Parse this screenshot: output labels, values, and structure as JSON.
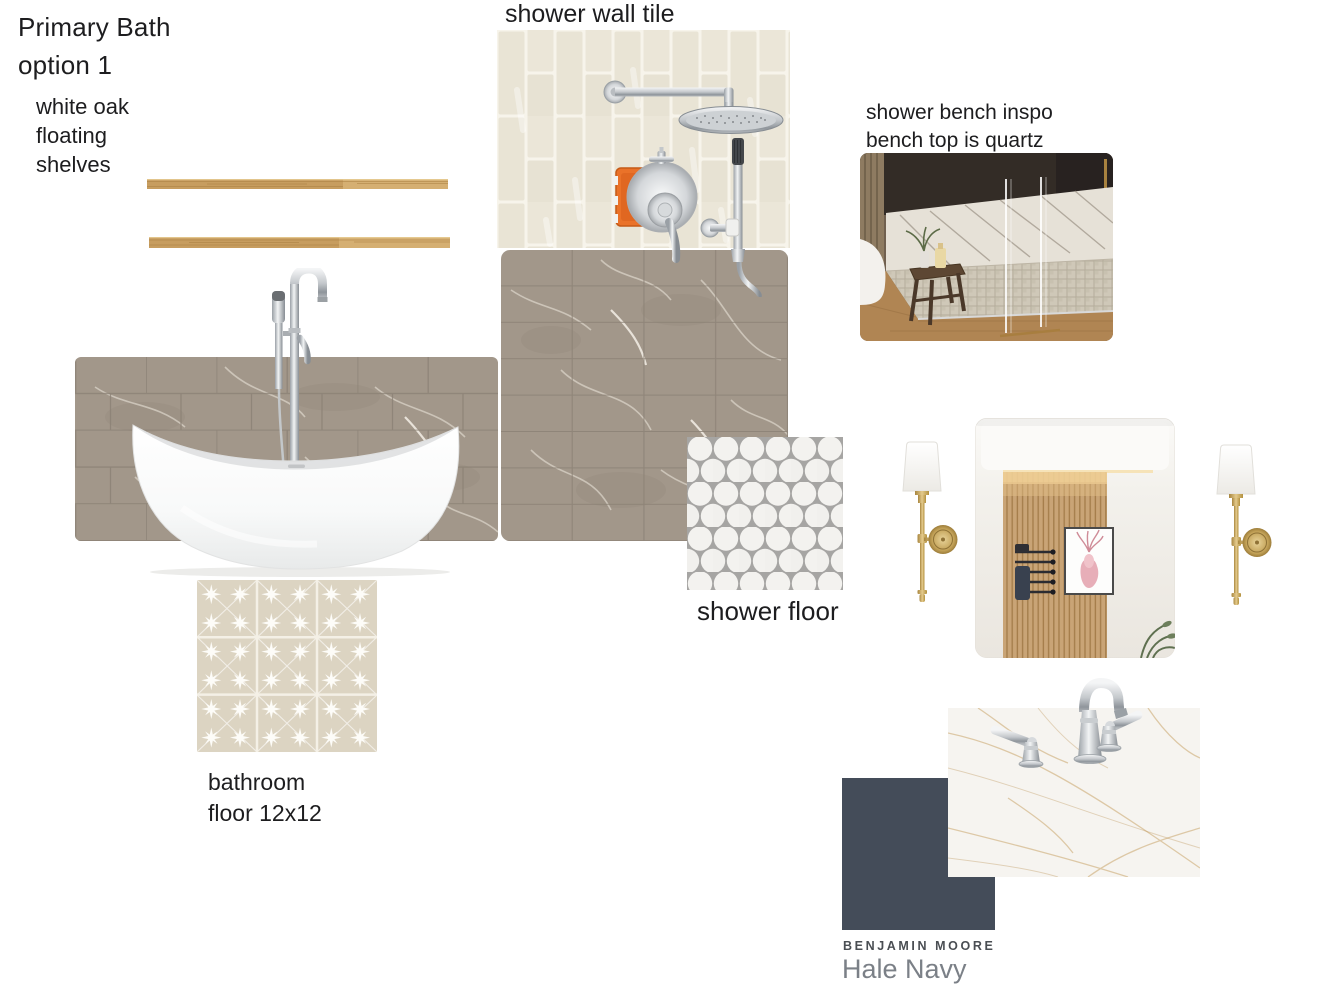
{
  "board": {
    "title": "Primary Bath\noption 1",
    "labels": {
      "shelves": "white oak\nfloating\nshelves",
      "shower_wall_tile": "shower wall tile",
      "shower_bench": "shower bench inspo\nbench top is quartz",
      "shower_floor": "shower floor",
      "bathroom_floor": "bathroom\nfloor 12x12"
    },
    "paint": {
      "brand": "BENJAMIN MOORE",
      "name": "Hale Navy"
    }
  },
  "colors": {
    "hale_navy": "#444c59",
    "white_oak": "#c79d5f",
    "shower_wall_tile": "#e9e4d5",
    "marble_tile": "#a2978a",
    "shower_floor_grout": "#a6a5a3",
    "shower_floor_dot": "#f3f2ef",
    "bathroom_floor_tile": "#dcd4c2",
    "quartz": "#f6f4f0",
    "brass": "#c3a258",
    "chrome": "#c6cacd",
    "text": "#1d1d1f",
    "brand_text": "#4a4e53",
    "paint_name_text": "#7b8087"
  }
}
